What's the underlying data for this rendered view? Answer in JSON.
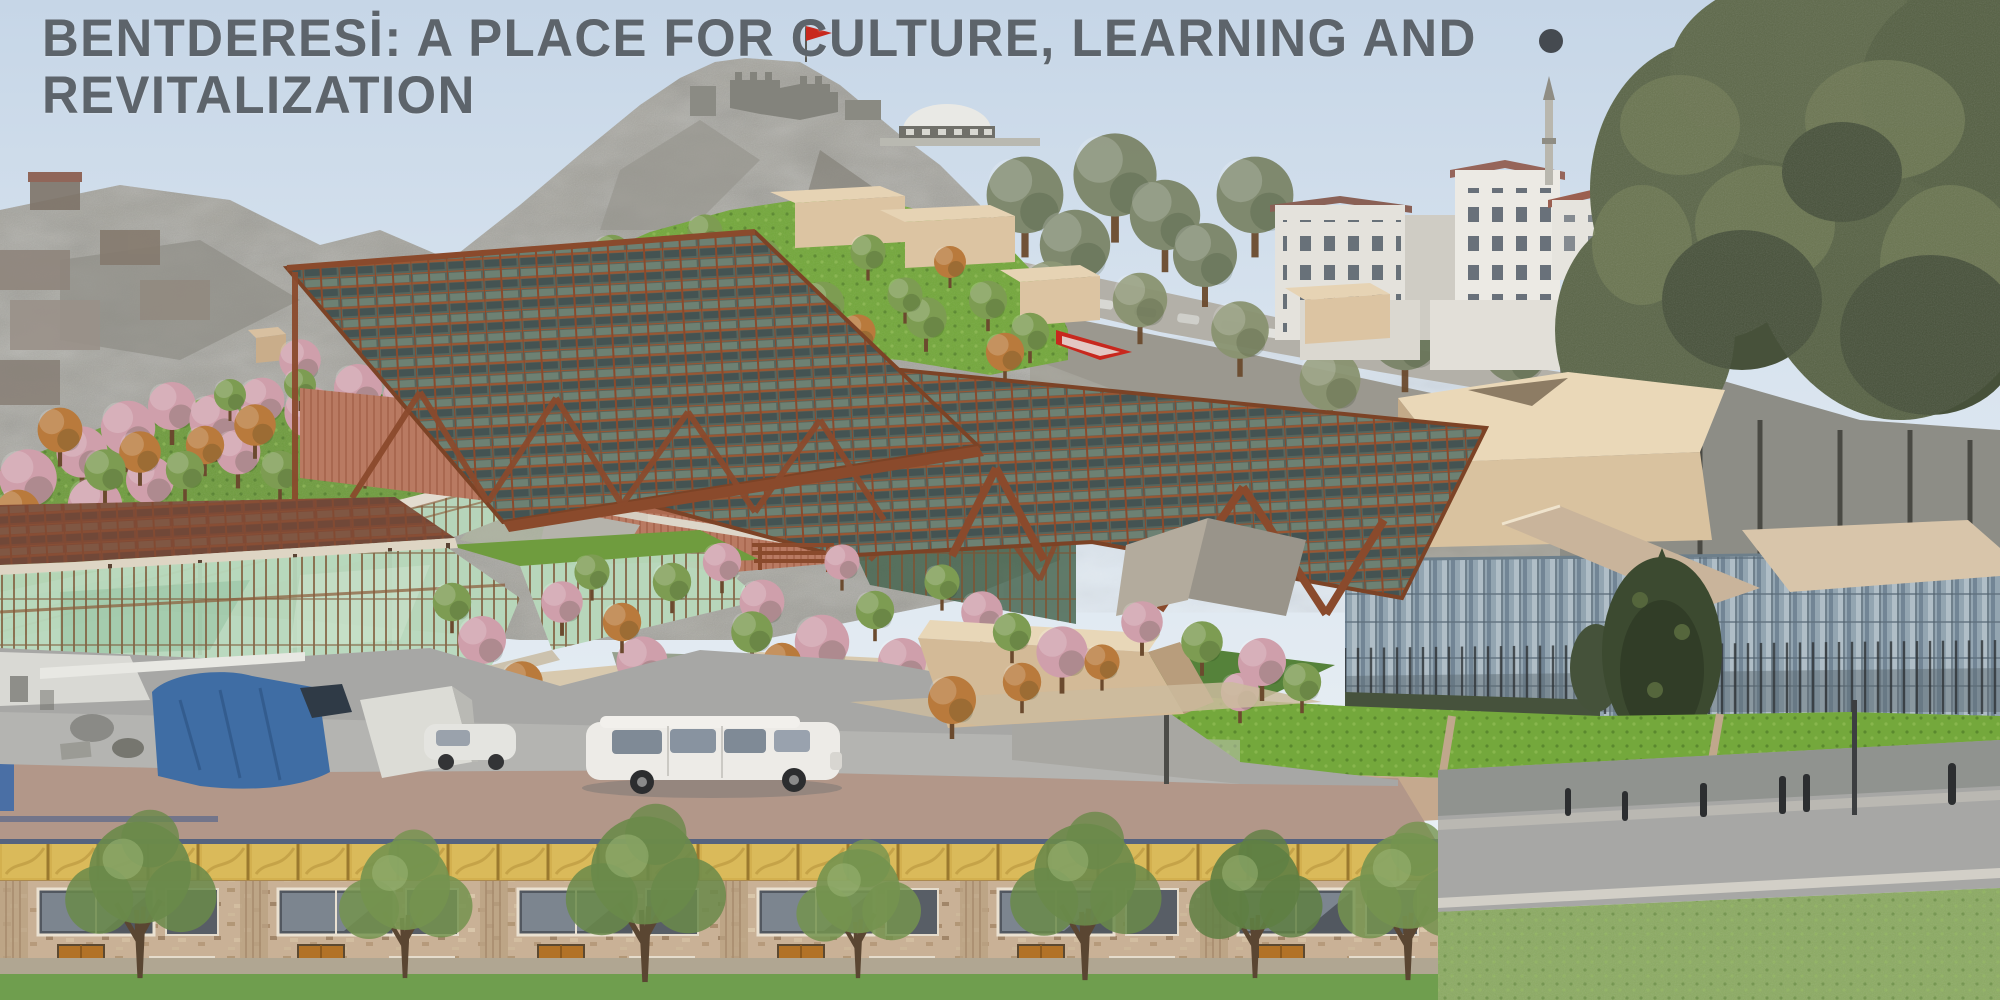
{
  "title": {
    "line1": "BENTDERESİ: A PLACE FOR CULTURE, LEARNING AND",
    "line2": "REVITALIZATION"
  },
  "palette": {
    "title_gray": "#5d646b",
    "sky_top": "#c6d6e7",
    "sky_bottom": "#eef3f6",
    "flag_red": "#c8281e",
    "canopy_rust": "#8a4a2c",
    "canopy_panel": "#56655d",
    "grass_bright": "#74a83c",
    "massing_beige": "#dcc4a2",
    "glass_green": "#b7d8bc",
    "blossom_pink": "#cf9fab",
    "autumn_orange": "#b97a3c",
    "tree_green": "#7d9c52",
    "curtain_glass": "#93a5b1",
    "ground_taupe": "#b29789",
    "facade_gold": "#d3b14e",
    "facade_brick": "#c8b299",
    "door_orange": "#b06f22",
    "road_gray": "#a7a7a5",
    "grass_foreground": "#8cab63",
    "tarp_blue": "#3f6da4"
  },
  "scene": {
    "landmarks": [
      "castle-hill-with-flag",
      "hillside-apartment-buildings",
      "minaret",
      "proposed-canopy-building-render",
      "green-roof-terraces",
      "glass-pavilion",
      "glass-office-building",
      "street-with-vehicles",
      "brick-facade-photo-strip",
      "road-with-bollards"
    ]
  }
}
